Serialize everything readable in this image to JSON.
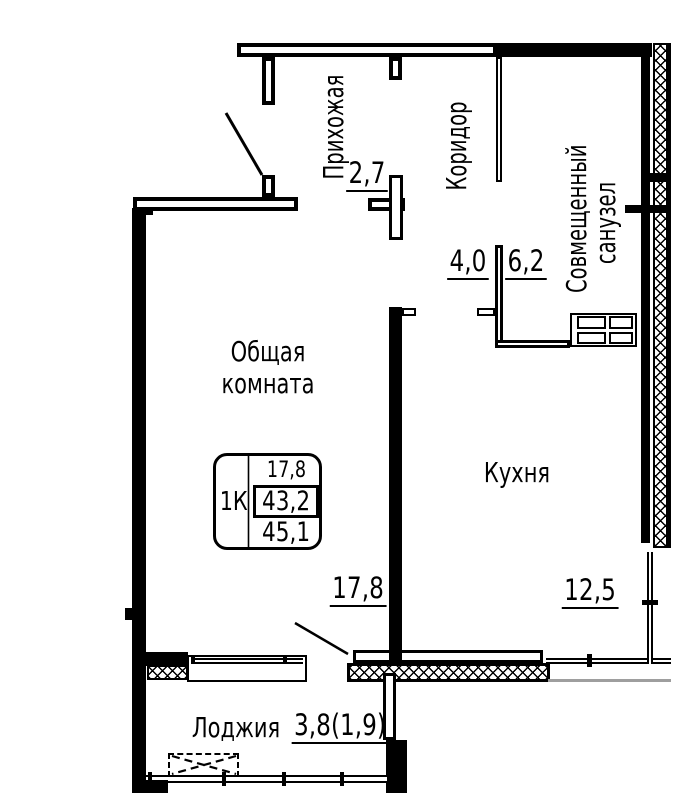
{
  "plan": {
    "rooms": {
      "hallway": {
        "name": "Прихожая",
        "area": "2,7"
      },
      "corridor": {
        "name": "Коридор",
        "area": "4,0"
      },
      "bathroom": {
        "name_line1": "Совмещенный",
        "name_line2": "санузел",
        "area": "6,2"
      },
      "living_room": {
        "name_line1": "Общая",
        "name_line2": "комната",
        "area": "17,8"
      },
      "kitchen": {
        "name": "Кухня",
        "area": "12,5"
      },
      "loggia": {
        "name": "Лоджия",
        "area": "3,8(1,9)"
      }
    },
    "stamp": {
      "unit_type": "1К",
      "living_area": "17,8",
      "total_area": "43,2",
      "total_area_with_balcony": "45,1"
    },
    "colors": {
      "line": "#000000",
      "wall_fill": "#ffffff",
      "context_line": "#9e9e9e"
    }
  }
}
